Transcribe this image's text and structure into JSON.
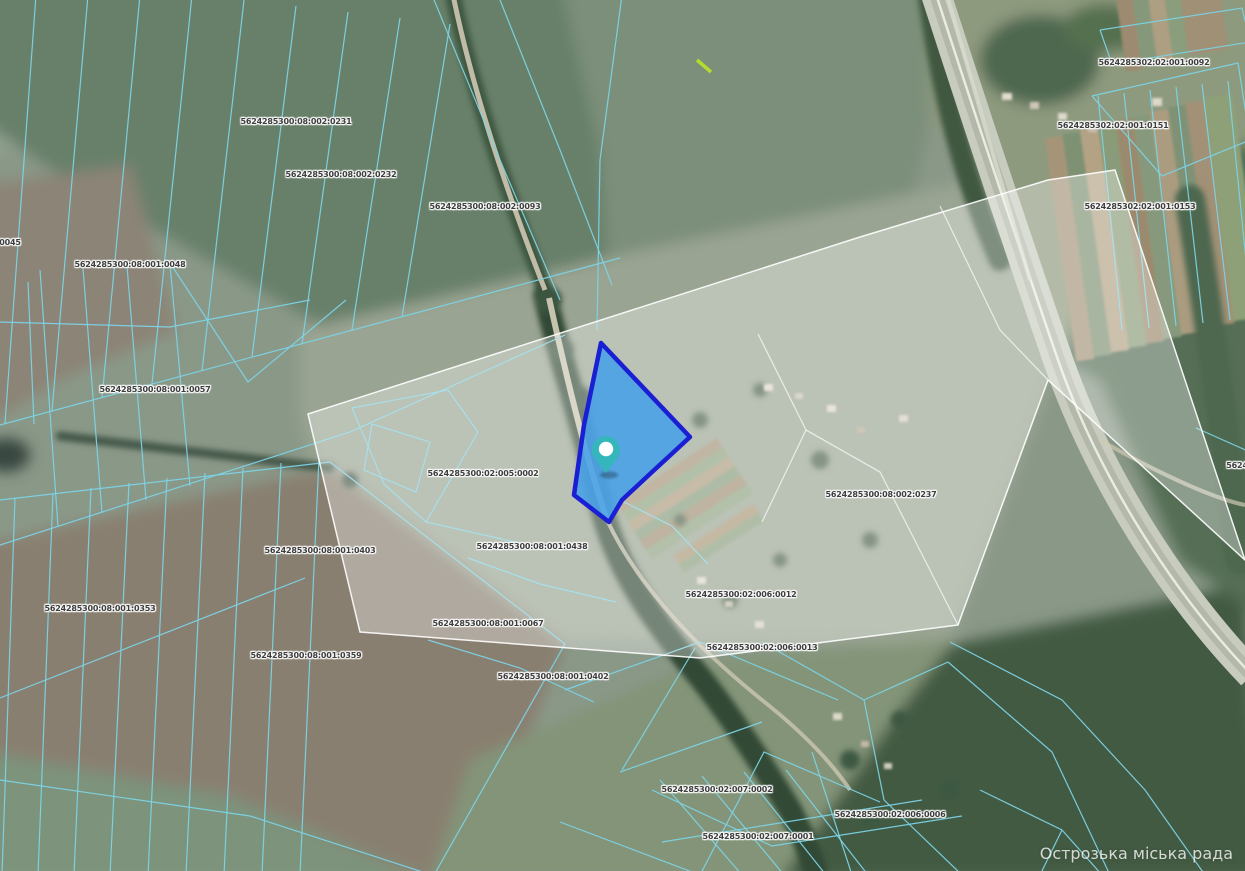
{
  "map": {
    "watermark": "Острозька міська рада",
    "colors": {
      "parcel_line": "#7cd3e6",
      "selected_fill": "#47a1e8",
      "selected_border": "#1b1fd4",
      "pin": "#35b6bd",
      "pin_center": "#ffffff",
      "overlay_fill": "rgba(255,255,255,0.33)",
      "overlay_border": "rgba(255,255,255,0.9)",
      "label_text": "#3d3d3d"
    },
    "labels": [
      {
        "text": "5624285300:08:002:0231",
        "x": 296,
        "y": 122
      },
      {
        "text": "5624285300:08:002:0232",
        "x": 341,
        "y": 175
      },
      {
        "text": "5624285300:08:002:0093",
        "x": 485,
        "y": 207
      },
      {
        "text": "0045",
        "x": 10,
        "y": 243
      },
      {
        "text": "5624285300:08:001:0048",
        "x": 130,
        "y": 265
      },
      {
        "text": "5624285300:08:001:0057",
        "x": 155,
        "y": 390
      },
      {
        "text": "5624285300:02:005:0002",
        "x": 483,
        "y": 474
      },
      {
        "text": "5624285300:08:001:0438",
        "x": 532,
        "y": 547
      },
      {
        "text": "5624285300:08:001:0403",
        "x": 320,
        "y": 551
      },
      {
        "text": "5624285300:08:001:0353",
        "x": 100,
        "y": 609
      },
      {
        "text": "5624285300:08:001:0359",
        "x": 306,
        "y": 656
      },
      {
        "text": "5624285300:08:001:0067",
        "x": 488,
        "y": 624
      },
      {
        "text": "5624285300:08:001:0402",
        "x": 553,
        "y": 677
      },
      {
        "text": "5624285300:08:002:0237",
        "x": 881,
        "y": 495
      },
      {
        "text": "5624285300:02:006:0012",
        "x": 741,
        "y": 595
      },
      {
        "text": "5624285300:02:006:0013",
        "x": 762,
        "y": 648
      },
      {
        "text": "5624285302:02:001:0092",
        "x": 1154,
        "y": 63
      },
      {
        "text": "5624285302:02:001:0151",
        "x": 1113,
        "y": 126
      },
      {
        "text": "5624285302:02:001:0153",
        "x": 1140,
        "y": 207
      },
      {
        "text": "5624285300:02:007:0002",
        "x": 717,
        "y": 790
      },
      {
        "text": "5624285300:02:006:0006",
        "x": 890,
        "y": 815
      },
      {
        "text": "5624285300:02:007:0001",
        "x": 758,
        "y": 837
      },
      {
        "text": "5624",
        "x": 1237,
        "y": 466
      }
    ],
    "selected_parcel": {
      "points": "601,343 690,437 651,473 622,500 609,522 574,495 584,425"
    },
    "pin": {
      "x": 606,
      "y": 452
    },
    "overlay": {
      "points": "308,414 860,237 1048,180 1115,170 1245,560 1048,380 958,625 700,658 360,632"
    },
    "overlay_lines": [
      "758,334 806,430 762,522",
      "940,206 1000,330 1048,380",
      "806,430 880,472 958,625"
    ],
    "parcel_lines": [
      "36,-5 5,423",
      "88,-5 52,411",
      "140,-5 102,398",
      "192,-5 152,384",
      "244,0 202,371",
      "296,6 252,357",
      "348,12 302,344",
      "400,18 352,330",
      "450,24 402,317",
      "0,425 620,258",
      "0,545 350,432 565,335",
      "0,322 170,327 310,300",
      "40,270 58,527",
      "83,268 102,513",
      "127,266 146,500",
      "170,264 190,486",
      "172,266 248,382 346,300",
      "28,282 34,424",
      "432,-5 500,160 560,300",
      "498,-5 560,150 612,285",
      "622,-5 600,160 597,330",
      "352,408 448,390 478,432",
      "352,408 384,484 426,522 524,544",
      "426,522 478,432",
      "372,424 430,442 416,492 364,470 372,424",
      "624,502 672,526 708,564",
      "468,558 540,584 616,602",
      "428,640 520,668 594,702",
      "15,498 2,875",
      "53,493 38,875",
      "91,488 74,875",
      "129,483 110,875",
      "167,478 148,875",
      "205,473 186,875",
      "243,468 224,875",
      "281,463 262,875",
      "319,458 300,875",
      "0,500 330,462",
      "330,462 565,644 434,875",
      "0,698 305,578",
      "0,780 250,816 432,875",
      "565,690 700,642 838,700",
      "620,772 762,722",
      "700,875 764,752 880,802",
      "812,752 852,875",
      "762,642 864,700 948,662",
      "864,700 884,800",
      "560,822 700,875",
      "948,662 1052,752 1110,875",
      "884,800 962,875",
      "695,648 622,770",
      "660,780 742,875",
      "702,776 784,875",
      "744,772 826,875",
      "786,770 868,875",
      "652,790 772,846 962,816",
      "662,842 922,800",
      "980,790 1062,830 1102,875",
      "1062,830 1040,875",
      "1098,96 1122,330",
      "1124,93 1149,328",
      "1150,90 1176,326",
      "1176,87 1203,323",
      "1202,84 1230,320",
      "1228,81 1250,300",
      "1092,96 1238,63 1250,140 1162,176 1092,96",
      "1100,30 1242,8 1250,42 1112,64 1100,30",
      "1196,428 1250,452",
      "950,642 1062,700 1145,790 1205,875"
    ]
  }
}
